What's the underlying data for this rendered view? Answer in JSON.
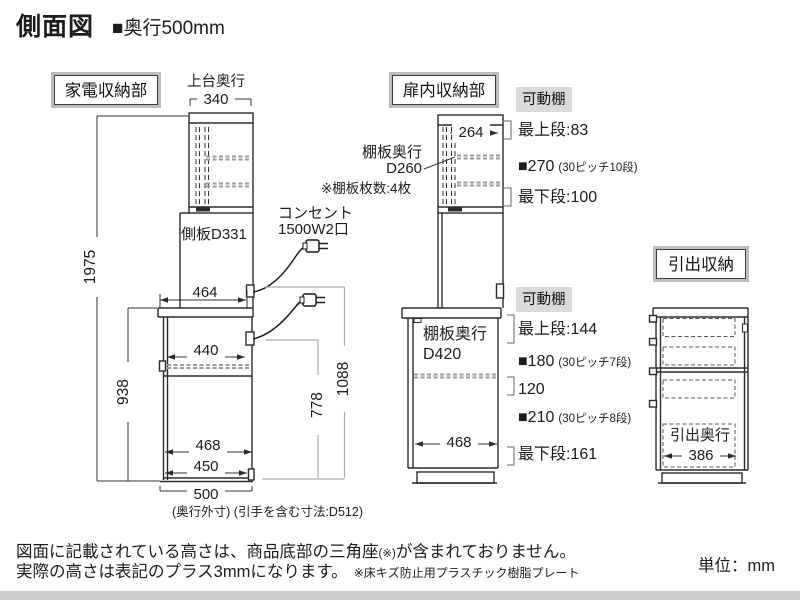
{
  "header": {
    "title": "側面図",
    "subtitle": "■奥行500mm"
  },
  "appliance": {
    "label": "家電収納部",
    "top_depth_caption": "上台奥行",
    "dim_top_depth": "340",
    "dim_total_height": "1975",
    "side_panel": "側板D331",
    "dim_counter_depth": "464",
    "dim_counter_height": "938",
    "dim_shelf_clear": "440",
    "dim_open_height": "778",
    "dim_lower_height": "1088",
    "dim_inner_depth": "468",
    "dim_door_depth": "450",
    "dim_base_depth": "500",
    "base_note": "(奥行外寸) (引手を含む寸法:D512)",
    "outlet_line1": "コンセント",
    "outlet_line2": "1500W2口"
  },
  "door_section": {
    "label": "扉内収納部",
    "upper": {
      "badge": "可動棚",
      "dim_inner": "264",
      "shelf_depth_line1": "棚板奥行",
      "shelf_depth_line2": "D260",
      "shelf_count": "※棚板枚数:4枚",
      "rows": [
        {
          "main": "最上段:83",
          "sub": ""
        },
        {
          "main": "■270",
          "sub": "(30ピッチ10段)"
        },
        {
          "main": "最下段:100",
          "sub": ""
        }
      ]
    },
    "lower": {
      "badge": "可動棚",
      "shelf_depth_line1": "棚板奥行",
      "shelf_depth_line2": "D420",
      "dim_inner": "468",
      "rows": [
        {
          "main": "最上段:144",
          "sub": ""
        },
        {
          "main": "■180",
          "sub": "(30ピッチ7段)"
        },
        {
          "main": "120",
          "sub": ""
        },
        {
          "main": "■210",
          "sub": "(30ピッチ8段)"
        },
        {
          "main": "最下段:161",
          "sub": ""
        }
      ]
    }
  },
  "drawer_section": {
    "label": "引出収納",
    "depth_caption": "引出奥行",
    "dim_depth": "386"
  },
  "footer": {
    "note1_a": "図面に記載されている高さは、商品底部の三角座",
    "note1_b": "(※)",
    "note1_c": "が含まれておりません。",
    "note2": "実際の高さは表記のプラス3mmになります。",
    "note2_small": "※床キズ防止用プラスチック樹脂プレート",
    "unit": "単位：mm",
    "bar_color": "#cccccc"
  }
}
